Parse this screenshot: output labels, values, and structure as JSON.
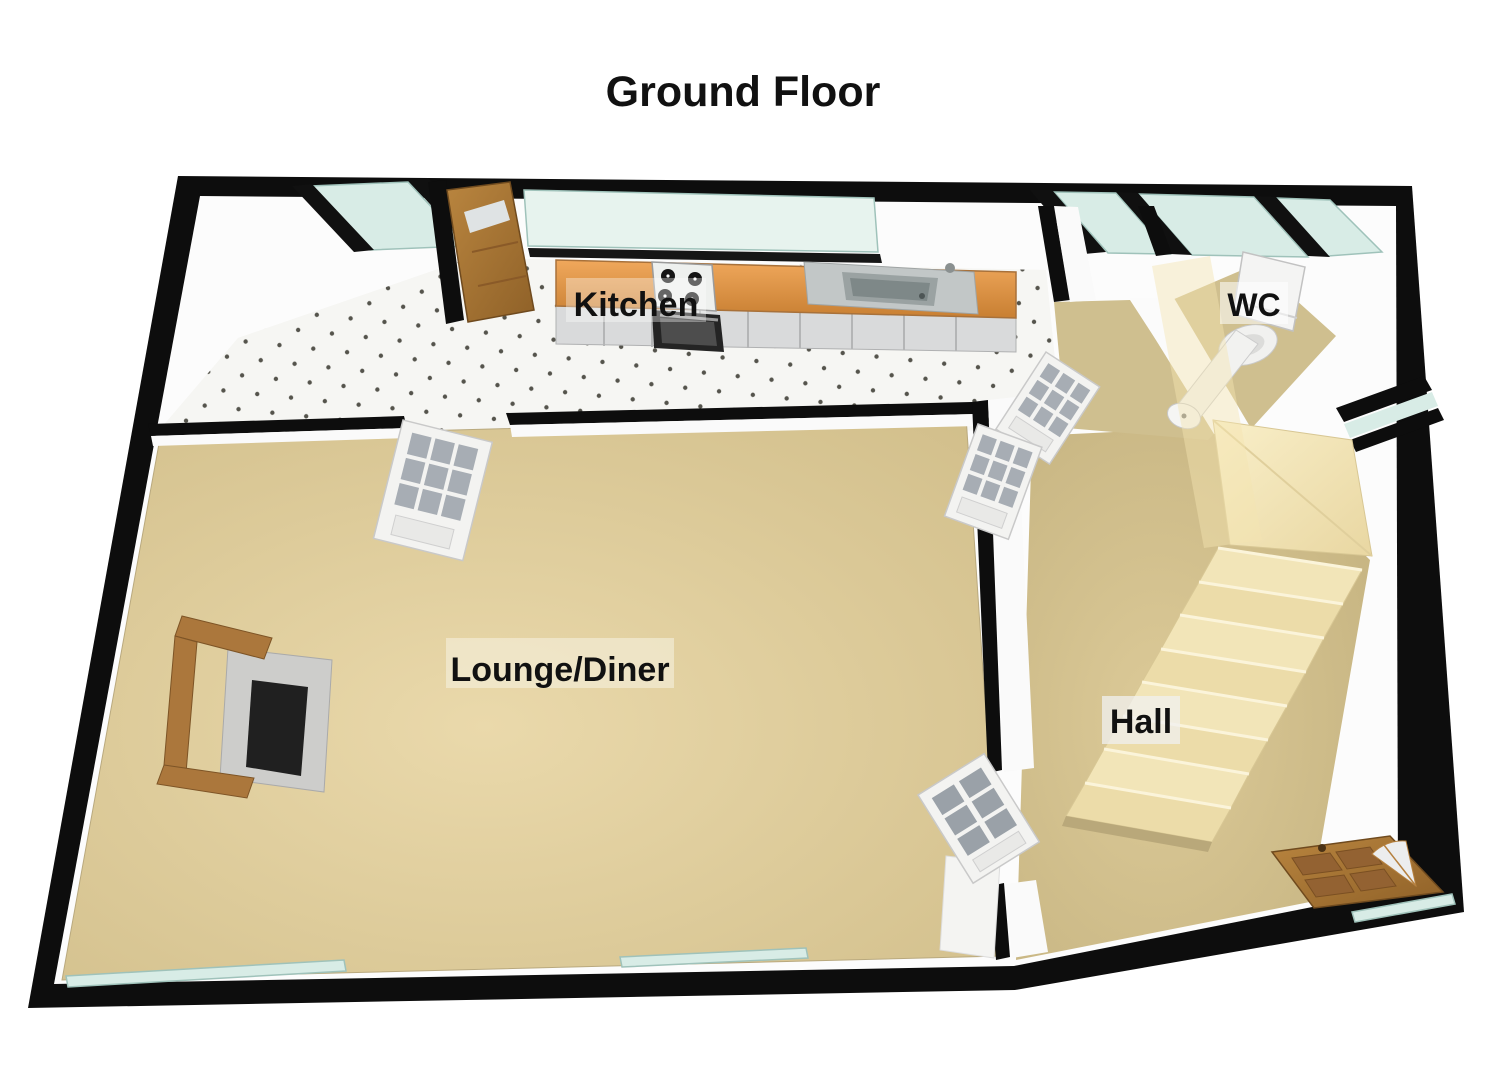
{
  "title": "Ground Floor",
  "rooms": {
    "kitchen": {
      "label": "Kitchen"
    },
    "wc": {
      "label": "WC"
    },
    "lounge_diner": {
      "label": "Lounge/Diner"
    },
    "hall": {
      "label": "Hall"
    }
  },
  "colors": {
    "wall": "#0d0d0d",
    "floor_tan": "#cfbf8f",
    "kitchen_floor": "#f6f6f3",
    "worktop_wood": "#e29a4e",
    "cabinet_grey": "#d9dadb",
    "glass": "#d8ece6",
    "stairs_cream": "#f2e5b8",
    "door_wood": "#ab773c",
    "label_text": "#111111"
  }
}
